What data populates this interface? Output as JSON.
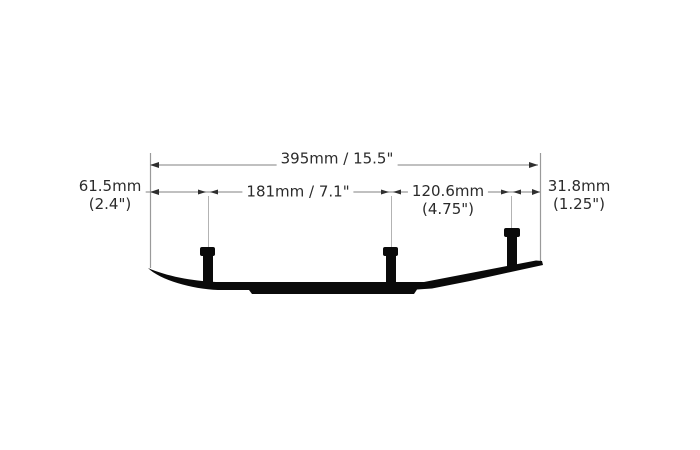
{
  "diagram": {
    "labels": {
      "total": "395mm / 15.5\"",
      "left_offset": {
        "line1": "61.5mm",
        "line2": "(2.4\")"
      },
      "center_span": "181mm / 7.1\"",
      "rear_span": {
        "line1": "120.6mm",
        "line2": "(4.75\")"
      },
      "right_offset": {
        "line1": "31.8mm",
        "line2": "(1.25\")"
      }
    },
    "colors": {
      "background": "#ffffff",
      "silhouette": "#0a0a0a",
      "dimension_line": "#9a9a9a",
      "arrow": "#2f2f2f",
      "text": "#2b2b2b"
    }
  }
}
